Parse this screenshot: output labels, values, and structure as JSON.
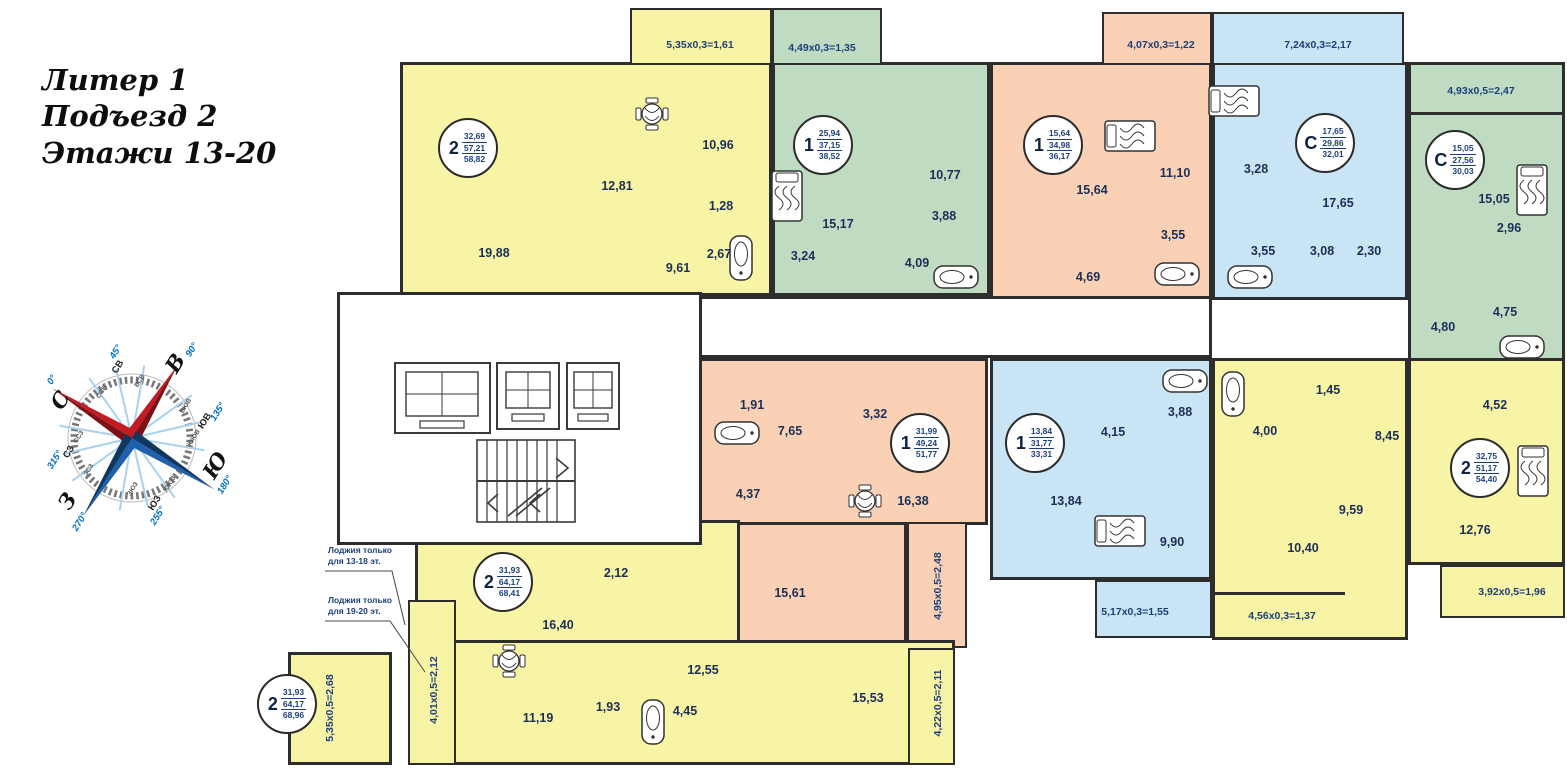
{
  "title": {
    "line1": "Литер 1",
    "line2": "Подъезд 2",
    "line3": "Этажи 13-20"
  },
  "compass": {
    "cardinals": [
      {
        "label": "С",
        "deg": "0°"
      },
      {
        "label": "В",
        "deg": "90°"
      },
      {
        "label": "Ю",
        "deg": "180°"
      },
      {
        "label": "З",
        "deg": "270°"
      }
    ],
    "intercardinals": [
      {
        "label": "СВ",
        "deg": "45°"
      },
      {
        "label": "ЮВ",
        "deg": "135°"
      },
      {
        "label": "ЮЗ",
        "deg": "255°"
      },
      {
        "label": "СЗ",
        "deg": "315°"
      }
    ],
    "minors": [
      "ССВ",
      "ВСВ",
      "ВЮВ",
      "ЮЮВ",
      "ЮЮЗ",
      "ЗЮЗ",
      "ЗСЗ",
      "ССЗ"
    ]
  },
  "notes": {
    "loggia1a": "Лоджия только",
    "loggia1b": "для 13-18 эт.",
    "loggia2a": "Лоджия только",
    "loggia2b": "для 19-20 эт."
  },
  "colors": {
    "yellow": "#f8f4a6",
    "green": "#bfdcc3",
    "peach": "#fad1b5",
    "blue": "#c9e4f4",
    "wall": "#2d2d2d",
    "label": "#1c3f7a",
    "accent_blue": "#0070c6",
    "accent_red": "#c21b24"
  },
  "apartments": {
    "a1": {
      "unit": "2",
      "areas": [
        "32,69",
        "57,21",
        "58,82"
      ],
      "rooms": [
        "19,88",
        "12,81",
        "10,96",
        "1,28",
        "2,67",
        "9,61"
      ],
      "balcony": "5,35x0,3=1,61"
    },
    "a2": {
      "unit": "1",
      "areas": [
        "25,94",
        "37,15",
        "38,52"
      ],
      "rooms": [
        "15,17",
        "10,77",
        "3,88",
        "3,24",
        "4,09"
      ],
      "balcony": "4,49x0,3=1,35"
    },
    "a3": {
      "unit": "1",
      "areas": [
        "15,64",
        "34,98",
        "36,17"
      ],
      "rooms": [
        "15,64",
        "11,10",
        "3,55",
        "4,69"
      ],
      "balcony": "4,07x0,3=1,22"
    },
    "a4": {
      "unit": "С",
      "areas": [
        "17,65",
        "29,86",
        "32,01"
      ],
      "rooms": [
        "3,28",
        "17,65",
        "3,55",
        "3,08",
        "2,30"
      ],
      "balcony": "7,24x0,3=2,17"
    },
    "a5": {
      "unit": "С",
      "areas": [
        "15,05",
        "27,56",
        "30,03"
      ],
      "rooms": [
        "15,05",
        "2,96",
        "4,75",
        "4,80"
      ],
      "balcony": "4,93x0,5=2,47"
    },
    "a6": {
      "unit": "1",
      "areas": [
        "31,99",
        "49,24",
        "51,77"
      ],
      "rooms": [
        "1,91",
        "7,65",
        "3,32",
        "4,37",
        "16,38",
        "15,61"
      ],
      "balcony": "4,95x0,5=2,48"
    },
    "a7": {
      "unit": "1",
      "areas": [
        "13,84",
        "31,77",
        "33,31"
      ],
      "rooms": [
        "4,15",
        "3,88",
        "13,84",
        "9,90"
      ],
      "balcony": "5,17x0,3=1,55"
    },
    "a8": {
      "unit": "2",
      "areas": [
        "32,75",
        "51,17",
        "54,40"
      ],
      "rooms": [
        "1,45",
        "4,00",
        "8,45",
        "4,52",
        "9,59",
        "10,40",
        "12,76"
      ],
      "balconies": [
        "4,56x0,3=1,37",
        "3,92x0,5=1,96"
      ]
    },
    "a9": {
      "unit": "2",
      "areas": [
        "31,93",
        "64,17",
        "68,41"
      ],
      "rooms": [
        "2,12",
        "16,40",
        "11,19",
        "1,93",
        "4,45",
        "12,55",
        "15,53"
      ],
      "balconies": [
        "4,01x0,5=2,12",
        "4,22x0,5=2,11"
      ]
    },
    "a10": {
      "unit": "2",
      "areas": [
        "31,93",
        "64,17",
        "68,96"
      ],
      "balcony": "5,35x0,5=2,68"
    }
  }
}
